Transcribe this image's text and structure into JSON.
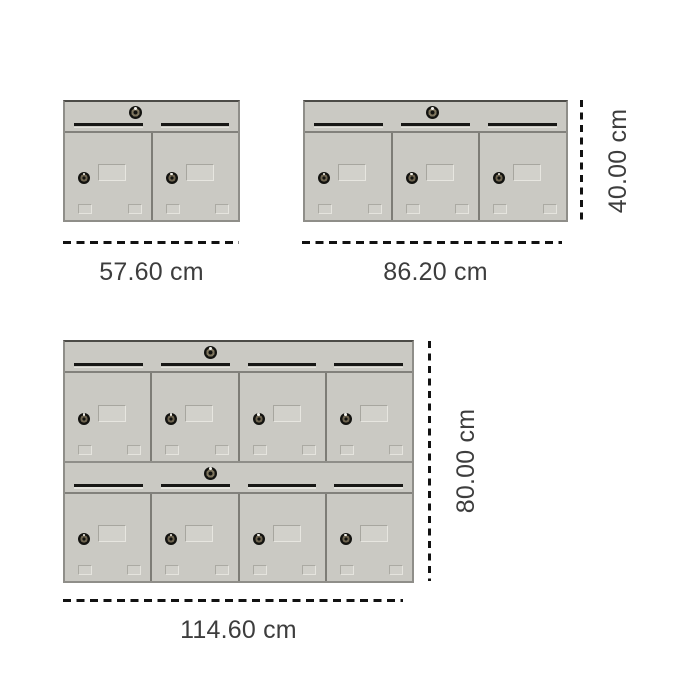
{
  "diagram": {
    "description": "Mailbox cabinet size comparison drawing with dimension lines",
    "units": [
      {
        "id": "small",
        "rows": 1,
        "doors_per_row": 2,
        "width_label": "57.60 cm"
      },
      {
        "id": "medium",
        "rows": 1,
        "doors_per_row": 3,
        "width_label": "86.20 cm",
        "height_label": "40.00 cm"
      },
      {
        "id": "large",
        "rows": 2,
        "doors_per_row": 4,
        "width_label": "114.60 cm",
        "height_label": "80.00 cm"
      }
    ],
    "icons": {
      "master_lock": "round-cylinder-lock",
      "door_lock": "round-cylinder-lock",
      "mail_slot": "horizontal-slot-line",
      "nameplate": "embossed-rectangle"
    },
    "colors": {
      "background": "#ffffff",
      "cabinet_body": "#cac9c3",
      "cabinet_border_top": "#4c4b47",
      "cabinet_border": "#8f8e89",
      "door_divider": "#7d7c76",
      "slot": "#171715",
      "dimension_line": "#121212",
      "label_text": "#3d3d3d"
    }
  }
}
